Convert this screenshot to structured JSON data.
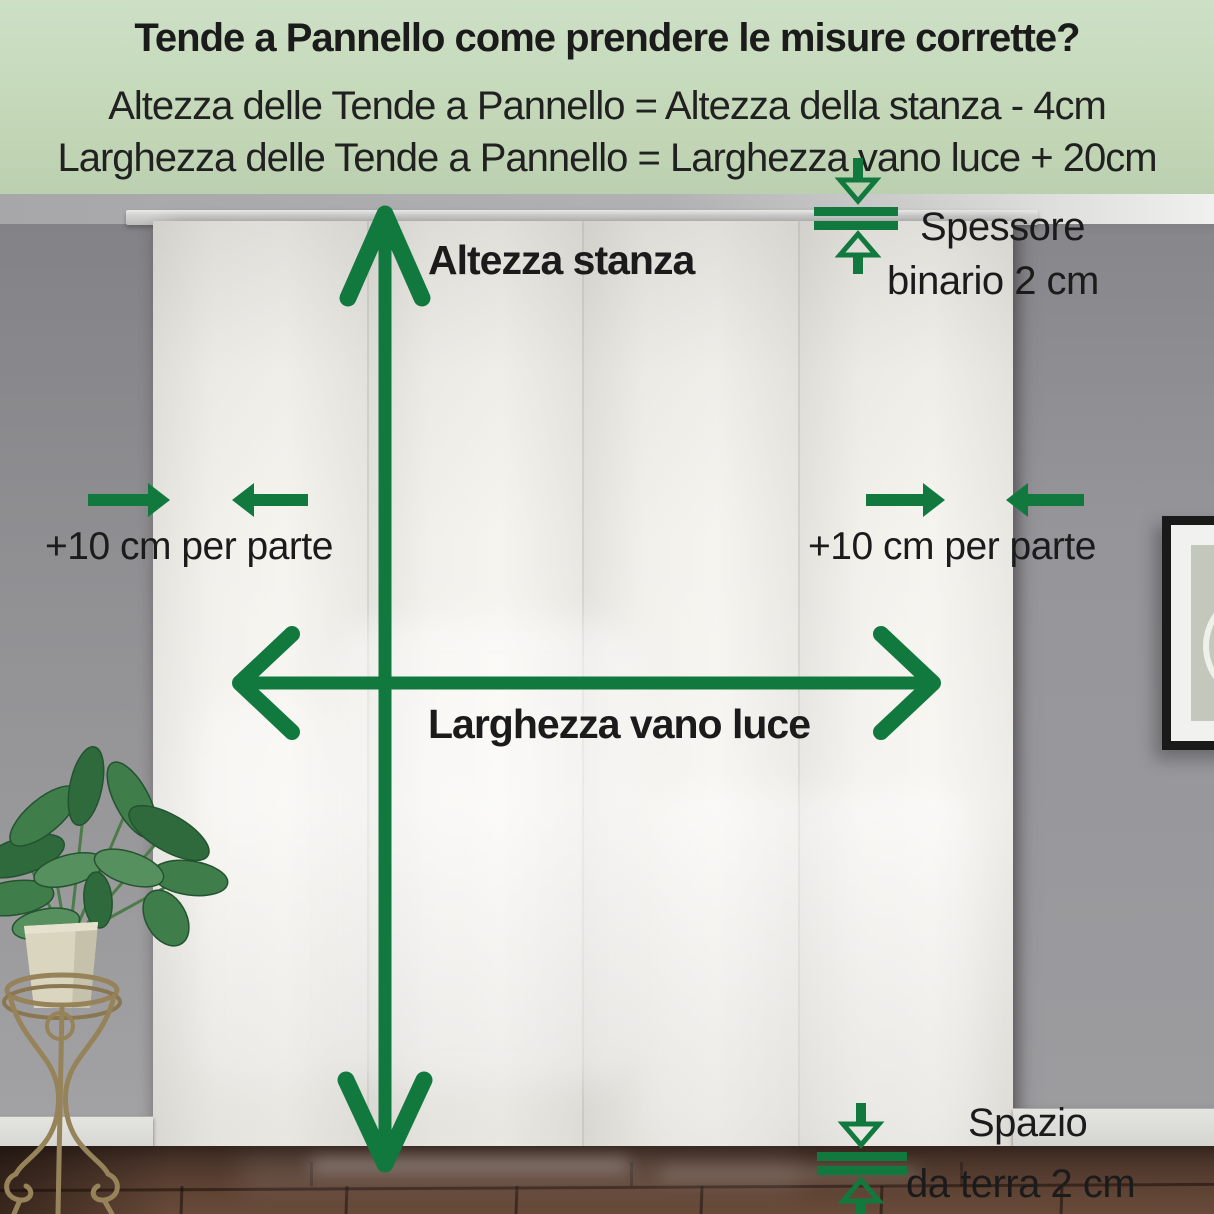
{
  "header": {
    "title": "Tende a Pannello come prendere le misure corrette?",
    "formula_height": "Altezza delle Tende a Pannello = Altezza della stanza - 4cm",
    "formula_width": "Larghezza delle Tende a Pannello = Larghezza vano luce + 20cm"
  },
  "annotations": {
    "room_height_label": "Altezza stanza",
    "opening_width_label": "Larghezza vano luce",
    "left_side_allowance_label": "+10 cm per parte",
    "right_side_allowance_label": "+10 cm per parte",
    "rail_thickness_label_line1": "Spessore",
    "rail_thickness_label_line2": "binario 2 cm",
    "floor_clearance_label_line1": "Spazio",
    "floor_clearance_label_line2": "da terra 2 cm"
  },
  "colors": {
    "accent_green": "#12793E",
    "header_background": "#C4D8BA",
    "label_text": "#1B1B1B"
  },
  "icons": {
    "room_height_arrow": "double-headed-vertical-arrow",
    "opening_width_arrow": "double-headed-horizontal-arrow",
    "side_allowance_arrows": "converging-horizontal-arrows",
    "rail_thickness_icon": "thickness-gauge-arrows",
    "floor_clearance_icon": "thickness-gauge-arrows"
  }
}
